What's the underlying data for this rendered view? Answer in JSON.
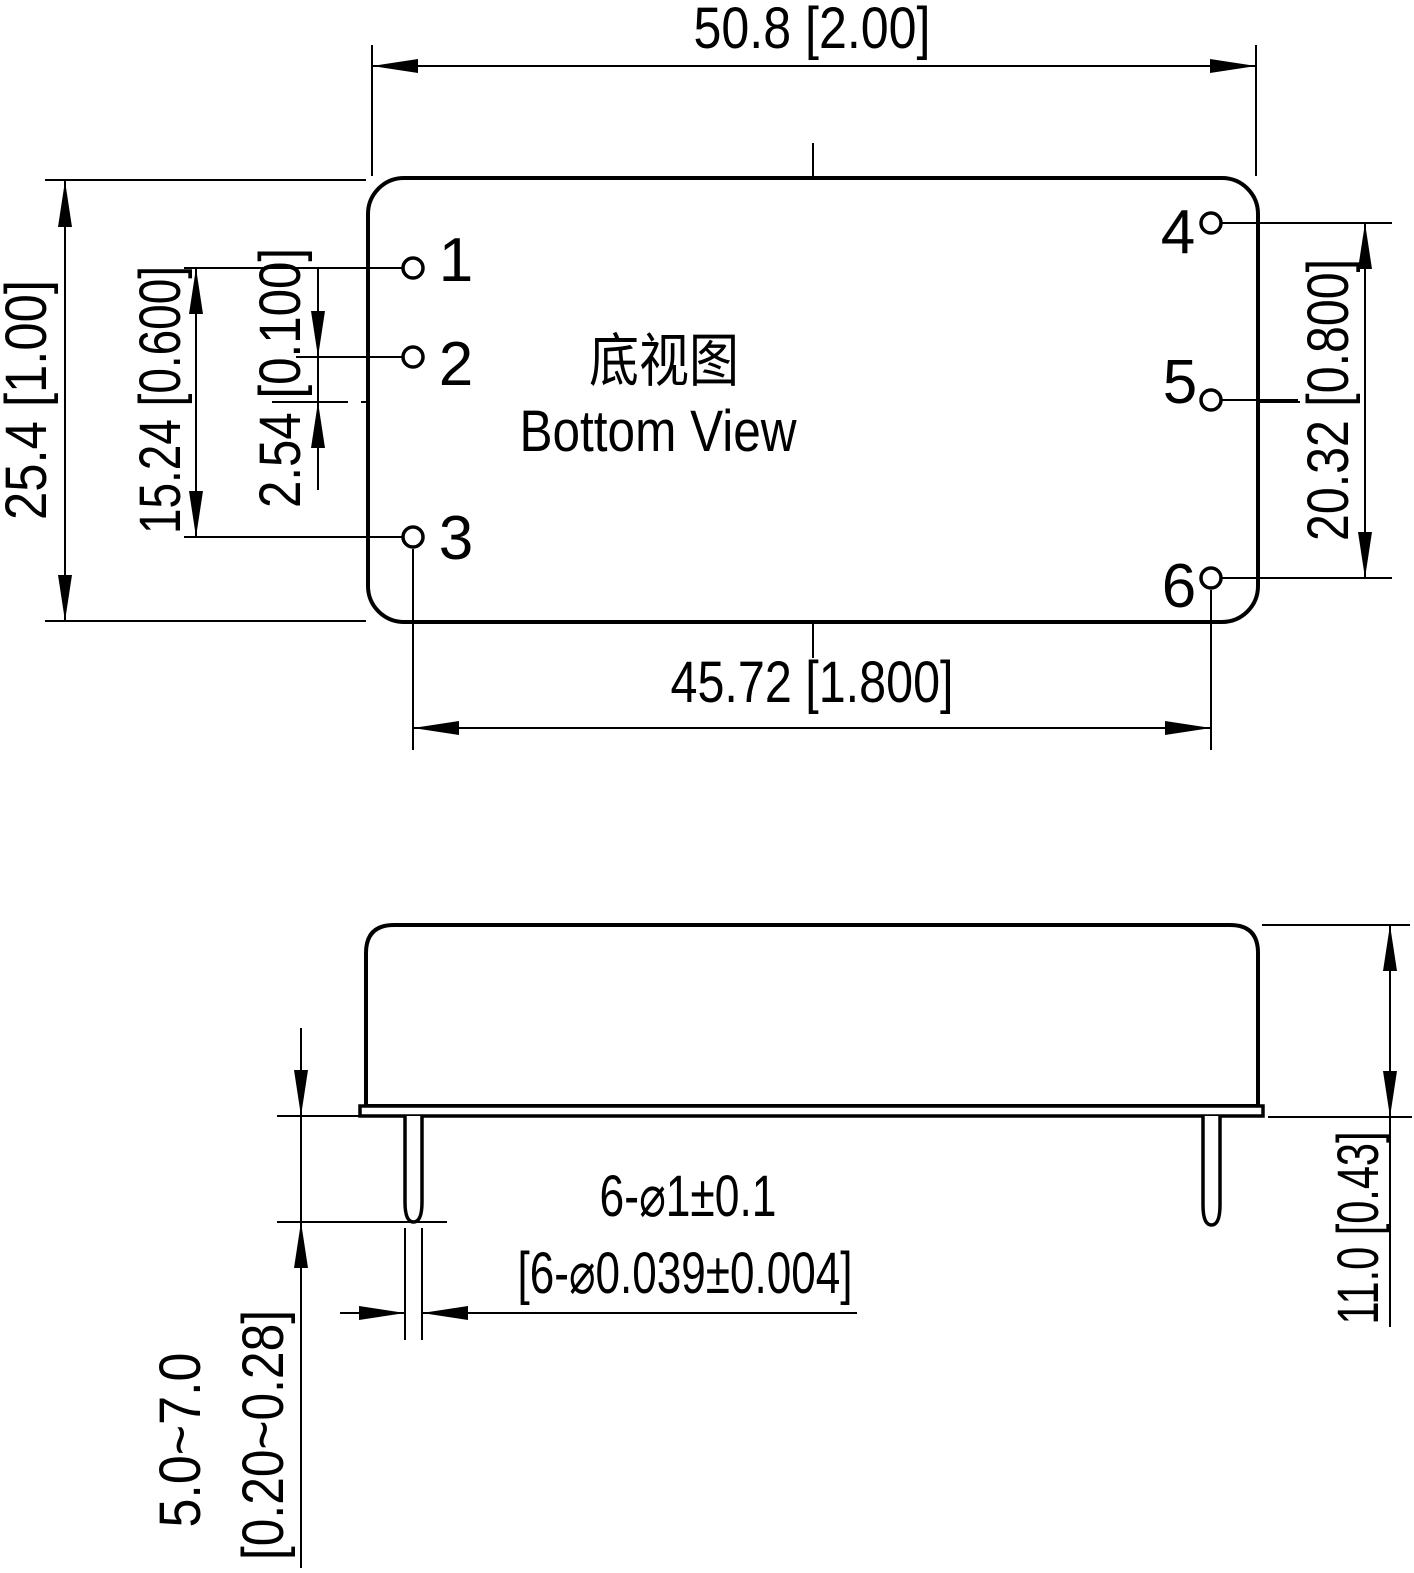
{
  "bottom_view": {
    "title_cn": "底视图",
    "title_en": "Bottom View",
    "pins": [
      "1",
      "2",
      "3",
      "4",
      "5",
      "6"
    ],
    "dims": {
      "overall_width": "50.8 [2.00]",
      "overall_depth": "25.4 [1.00]",
      "pin_span_135": "15.24 [0.600]",
      "pin_offset_center": "2.54 [0.100]",
      "pin_span_46": "20.32 [0.800]",
      "pin_column_span": "45.72 [1.800]"
    }
  },
  "side_view": {
    "dims": {
      "body_height": "11.0 [0.43]",
      "pin_length_mm": "5.0~7.0",
      "pin_length_in": "[0.20~0.28]",
      "pin_dia_mm": "6-⌀1±0.1",
      "pin_dia_in": "[6-⌀0.039±0.004]"
    }
  },
  "colors": {
    "line": "#000000",
    "background": "#ffffff"
  }
}
